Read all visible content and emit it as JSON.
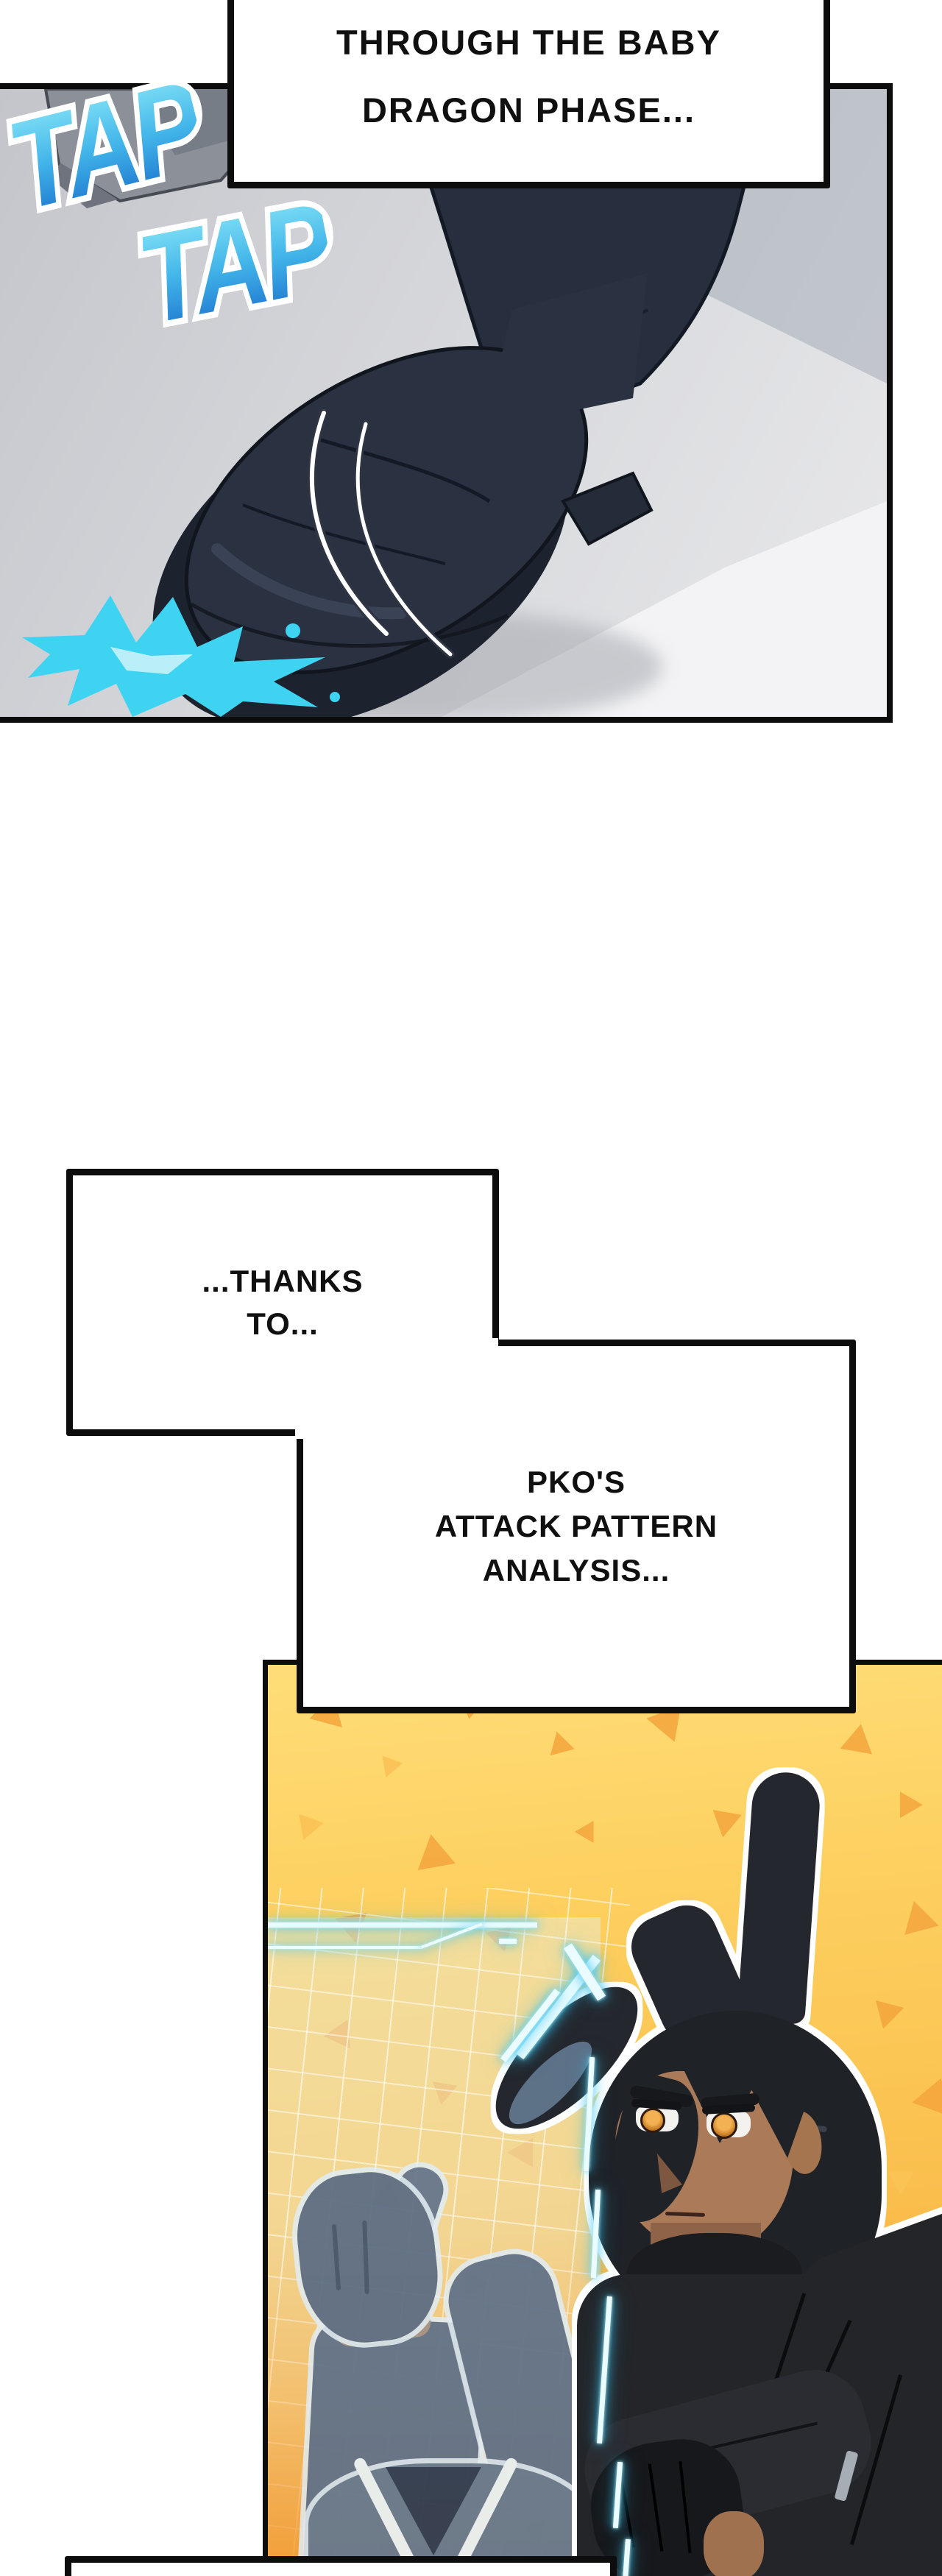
{
  "comic": {
    "bubbles": {
      "top": [
        "WE'RE BARELY JUMPING",
        "THROUGH THE BABY",
        "DRAGON PHASE..."
      ],
      "thanks": [
        "...THANKS",
        "TO..."
      ],
      "pko": [
        "PKO'S",
        "ATTACK PATTERN",
        "ANALYSIS..."
      ]
    },
    "sfx": {
      "tap1": "TAP",
      "tap2": "TAP"
    }
  },
  "palette": {
    "page_bg": "#ffffff",
    "panel_border": "#0d0d0d",
    "panel1_gray": "#d6d7da",
    "boot_navy": "#2a3140",
    "splash_cyan": "#3fd3f2",
    "tap_gradient_top": "#8ae8f8",
    "tap_gradient_bottom": "#1a6fcc",
    "panel2_yellow": "#fbc351",
    "triangle_orange": "#f3a43c",
    "hud_cyan": "#38c2ee",
    "hologram_blue": "#5f7189",
    "hair_black": "#1f2227",
    "skin_tan": "#ab7b59",
    "eye_amber": "#eca53e"
  }
}
